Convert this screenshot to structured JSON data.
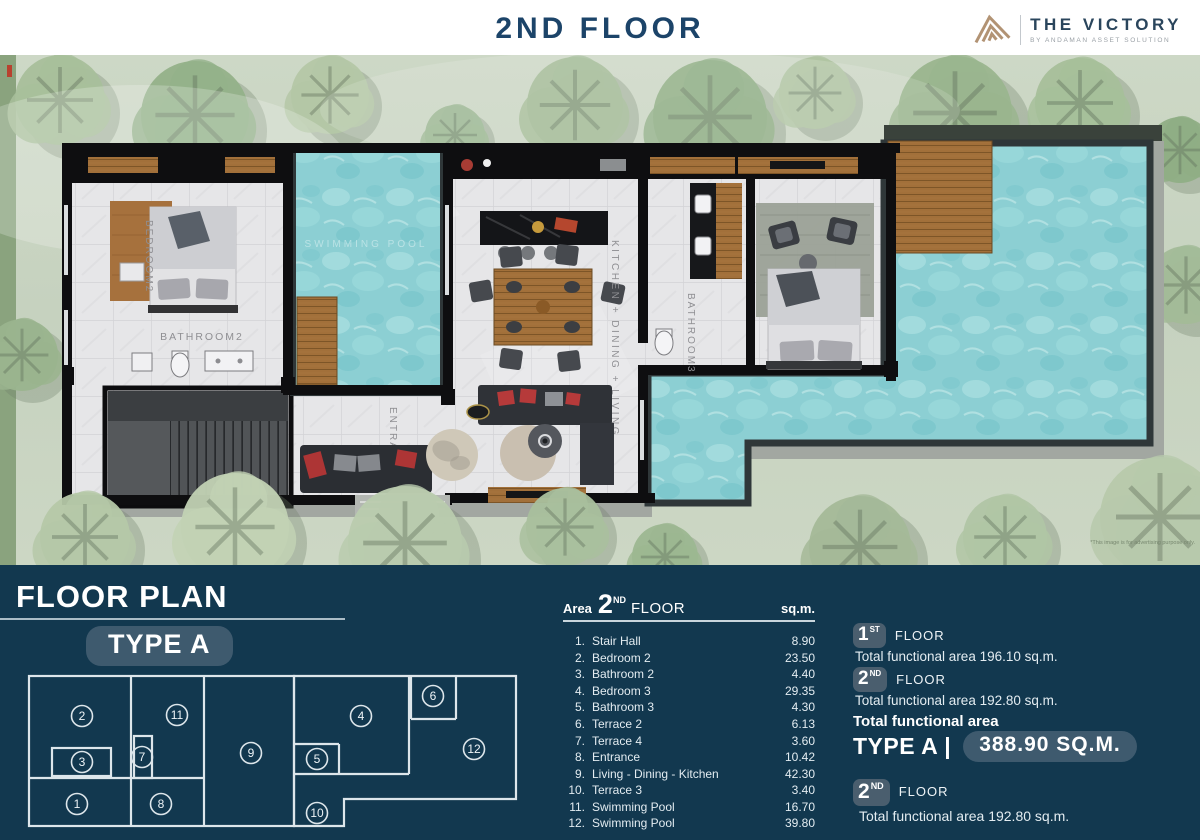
{
  "header": {
    "title": "2ND FLOOR",
    "brand": {
      "name": "THE VICTORY",
      "tagline": "BY ANDAMAN ASSET SOLUTION"
    }
  },
  "plan": {
    "labels": {
      "bedroom2": "BEDROOM2",
      "bathroom2": "BATHROOM2",
      "swimming_pool": "SWIMMING POOL",
      "kitchen_dining_living": "KITCHEN + DINING + LIVING",
      "bathroom3": "BATHROOM3",
      "entrance": "ENTRANCE"
    },
    "disclaimer": "*This image is for advertising purpose only."
  },
  "floor_plan_panel": {
    "title": "FLOOR PLAN",
    "type_label": "TYPE A",
    "diagram_rooms": [
      "1",
      "2",
      "3",
      "4",
      "5",
      "6",
      "7",
      "8",
      "9",
      "10",
      "11",
      "12"
    ],
    "table": {
      "area_label": "Area",
      "floor_number": "2",
      "floor_ordinal": "ND",
      "floor_word": "FLOOR",
      "unit_label": "sq.m.",
      "rows": [
        {
          "no": "1.",
          "name": "Stair Hall",
          "area": "8.90"
        },
        {
          "no": "2.",
          "name": "Bedroom 2",
          "area": "23.50"
        },
        {
          "no": "3.",
          "name": "Bathroom 2",
          "area": "4.40"
        },
        {
          "no": "4.",
          "name": "Bedroom 3",
          "area": "29.35"
        },
        {
          "no": "5.",
          "name": "Bathroom 3",
          "area": "4.30"
        },
        {
          "no": "6.",
          "name": "Terrace 2",
          "area": "6.13"
        },
        {
          "no": "7.",
          "name": "Terrace 4",
          "area": "3.60"
        },
        {
          "no": "8.",
          "name": "Entrance",
          "area": "10.42"
        },
        {
          "no": "9.",
          "name": "Living - Dining - Kitchen",
          "area": "42.30"
        },
        {
          "no": "10.",
          "name": "Terrace 3",
          "area": "3.40"
        },
        {
          "no": "11.",
          "name": "Swimming Pool",
          "area": "16.70"
        },
        {
          "no": "12.",
          "name": "Swimming Pool",
          "area": "39.80"
        }
      ]
    },
    "summary": {
      "first_floor": {
        "number": "1",
        "ordinal": "ST",
        "word": "FLOOR",
        "detail": "Total functional area 196.10 sq.m."
      },
      "second_floor": {
        "number": "2",
        "ordinal": "ND",
        "word": "FLOOR",
        "detail": "Total functional area 192.80 sq.m."
      },
      "total_label": "Total functional area",
      "total_type": "TYPE A |",
      "total_value": "388.90 SQ.M.",
      "second_floor_repeat": {
        "number": "2",
        "ordinal": "ND",
        "word": "FLOOR",
        "detail": "Total functional area 192.80 sq.m."
      }
    }
  },
  "colors": {
    "panel_navy": "#12384F",
    "pill_slate": "#3E5A6E",
    "badge_slate": "#4A5E6E",
    "title_navy": "#1C4469",
    "brand_tan": "#B29374",
    "pool_turquoise": "#8CCFD3",
    "grass_green": "#CBD6C3",
    "wood_brown": "#A2703A"
  }
}
